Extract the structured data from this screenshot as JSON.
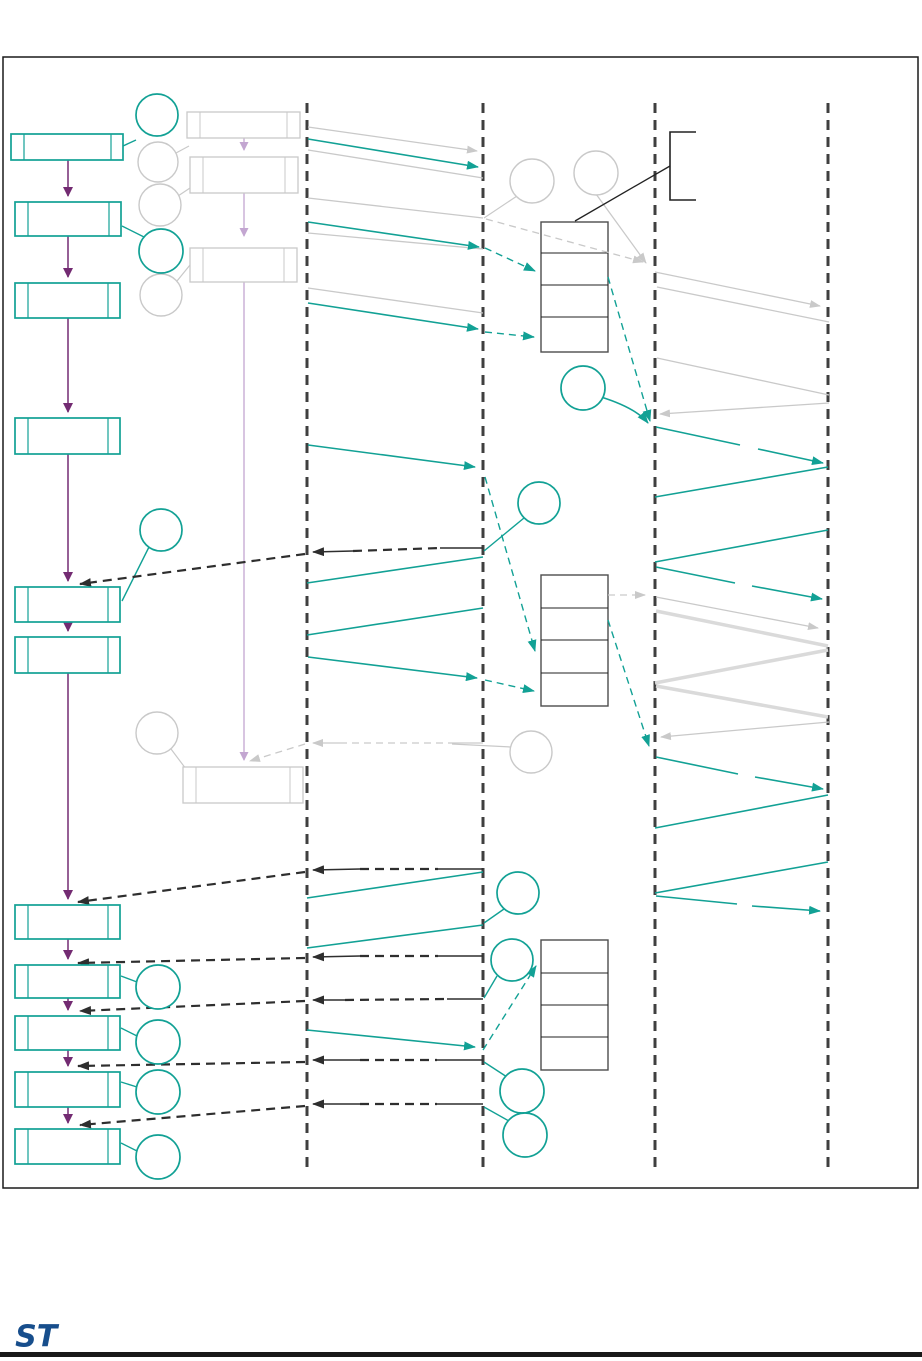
{
  "page": {
    "background": "#ffffff"
  },
  "logo": {
    "text": "ST",
    "name": "st-logo"
  },
  "colors": {
    "teal": "#12a195",
    "purple": "#732b72",
    "violet": "#c3a6d1",
    "dark": "#2e2e2e",
    "lifeline": "#3f3f3f",
    "gray_shape": "#c9c9c9",
    "gray_line": "#c9c9c9",
    "gray_thick": "#dadada",
    "table_border": "#4d4d4d",
    "table_divider": "#222222",
    "frame": "#1a1a1a",
    "bracket": "#222222",
    "logo_blue": "#174e8c",
    "footer_rule": "#191919",
    "box_fill": "#ffffff"
  },
  "diagram": {
    "frame": {
      "x": 3,
      "y": 57,
      "w": 915,
      "h": 1131
    },
    "lifelines": {
      "xs": [
        307,
        483,
        655,
        828
      ],
      "y1": 103,
      "y2": 1168
    },
    "flow_boxes": [
      [
        11,
        134,
        112,
        26
      ],
      [
        15,
        202,
        106,
        34
      ],
      [
        15,
        283,
        105,
        35
      ],
      [
        15,
        418,
        105,
        36
      ],
      [
        15,
        587,
        105,
        35
      ],
      [
        15,
        637,
        105,
        36
      ],
      [
        15,
        905,
        105,
        34
      ],
      [
        15,
        965,
        105,
        33
      ],
      [
        15,
        1016,
        105,
        34
      ],
      [
        15,
        1072,
        105,
        35
      ],
      [
        15,
        1129,
        105,
        35
      ]
    ],
    "gray_boxes": [
      [
        187,
        112,
        113,
        26
      ],
      [
        190,
        157,
        108,
        36
      ],
      [
        190,
        248,
        107,
        34
      ],
      [
        183,
        767,
        120,
        36
      ]
    ],
    "teal_circles": [
      [
        157,
        115,
        21
      ],
      [
        161,
        251,
        22
      ],
      [
        161,
        530,
        21
      ],
      [
        583,
        388,
        22
      ],
      [
        539,
        503,
        21
      ],
      [
        518,
        893,
        21
      ],
      [
        512,
        960,
        21
      ],
      [
        522,
        1091,
        22
      ],
      [
        525,
        1135,
        22
      ],
      [
        158,
        987,
        22
      ],
      [
        158,
        1042,
        22
      ],
      [
        158,
        1092,
        22
      ],
      [
        158,
        1157,
        22
      ]
    ],
    "gray_circles": [
      [
        158,
        162,
        20
      ],
      [
        160,
        205,
        21
      ],
      [
        161,
        295,
        21
      ],
      [
        532,
        181,
        22
      ],
      [
        596,
        173,
        22
      ],
      [
        157,
        733,
        21
      ],
      [
        531,
        752,
        21
      ]
    ],
    "tables": [
      {
        "x": 541,
        "y": 222,
        "w": 67,
        "h": 130,
        "rows": [
          253,
          285,
          317
        ]
      },
      {
        "x": 541,
        "y": 575,
        "w": 67,
        "h": 131,
        "rows": [
          608,
          640,
          673
        ]
      },
      {
        "x": 541,
        "y": 940,
        "w": 67,
        "h": 130,
        "rows": [
          973,
          1005,
          1037
        ]
      }
    ],
    "bracket_path": "M696,132 L670,132 L670,200 L696,200",
    "black_line": [
      575,
      221,
      670,
      166
    ],
    "teal_curve": "M601,397 Q636,408 648,423",
    "lines": {
      "teal_arrow": [
        [
          308,
          139,
          478,
          167
        ],
        [
          308,
          222,
          479,
          247
        ],
        [
          308,
          303,
          478,
          329
        ],
        [
          308,
          445,
          475,
          467
        ],
        [
          308,
          657,
          477,
          678
        ],
        [
          307,
          1030,
          475,
          1047
        ],
        [
          758,
          449,
          823,
          463
        ],
        [
          752,
          586,
          822,
          599
        ],
        [
          755,
          777,
          823,
          789
        ],
        [
          752,
          906,
          820,
          911
        ]
      ],
      "teal_line": [
        [
          656,
          427,
          740,
          445
        ],
        [
          656,
          567,
          735,
          583
        ],
        [
          656,
          757,
          738,
          774
        ],
        [
          656,
          896,
          737,
          904
        ],
        [
          483,
          557,
          307,
          583
        ],
        [
          483,
          608,
          307,
          635
        ],
        [
          483,
          872,
          307,
          898
        ],
        [
          307,
          948,
          483,
          925
        ],
        [
          828,
          467,
          655,
          497
        ],
        [
          828,
          530,
          655,
          562
        ],
        [
          828,
          795,
          655,
          828
        ],
        [
          828,
          862,
          655,
          893
        ]
      ],
      "teal_dash_arrow": [
        [
          485,
          248,
          535,
          271
        ],
        [
          485,
          332,
          534,
          337
        ],
        [
          608,
          277,
          650,
          421
        ],
        [
          485,
          477,
          535,
          651
        ],
        [
          485,
          680,
          534,
          691
        ],
        [
          608,
          620,
          649,
          746
        ],
        [
          483,
          1050,
          536,
          966
        ]
      ],
      "teal_leader": [
        [
          136,
          140,
          123,
          146
        ],
        [
          146,
          238,
          122,
          226
        ],
        [
          150,
          545,
          122,
          601
        ],
        [
          524,
          518,
          484,
          551
        ],
        [
          504,
          909,
          484,
          923
        ],
        [
          497,
          976,
          484,
          998
        ],
        [
          507,
          1077,
          484,
          1062
        ],
        [
          509,
          1121,
          484,
          1107
        ],
        [
          137,
          982,
          121,
          976
        ],
        [
          137,
          1036,
          121,
          1028
        ],
        [
          137,
          1087,
          121,
          1082
        ],
        [
          137,
          1151,
          121,
          1143
        ]
      ],
      "gray_arrow": [
        [
          308,
          127,
          477,
          151
        ],
        [
          596,
          194,
          646,
          263
        ],
        [
          655,
          272,
          820,
          306
        ],
        [
          656,
          597,
          818,
          628
        ],
        [
          829,
          403,
          660,
          414
        ],
        [
          829,
          722,
          661,
          737
        ]
      ],
      "gray_line": [
        [
          308,
          150,
          483,
          178
        ],
        [
          308,
          198,
          483,
          218
        ],
        [
          308,
          233,
          483,
          249
        ],
        [
          308,
          288,
          483,
          313
        ],
        [
          657,
          287,
          829,
          322
        ],
        [
          657,
          358,
          829,
          395
        ]
      ],
      "gray_leader": [
        [
          176,
          153,
          189,
          146
        ],
        [
          178,
          196,
          190,
          188
        ],
        [
          177,
          281,
          190,
          265
        ],
        [
          517,
          196,
          484,
          218
        ],
        [
          171,
          749,
          186,
          769
        ],
        [
          511,
          747,
          452,
          744
        ]
      ],
      "gray_dash_arrow": [
        [
          486,
          219,
          643,
          262
        ],
        [
          608,
          595,
          645,
          595
        ],
        [
          305,
          744,
          250,
          761
        ]
      ],
      "gray_stub": [
        [
          451,
          743,
          483,
          743
        ]
      ],
      "gray_arrow_stub": [
        [
          340,
          743,
          313,
          743
        ]
      ],
      "gray_dash_mid": [
        [
          340,
          743,
          451,
          743
        ]
      ],
      "thick_gray": [
        [
          656,
          611,
          828,
          646
        ],
        [
          828,
          650,
          655,
          683
        ],
        [
          656,
          686,
          828,
          717
        ]
      ],
      "dark_stub": [
        [
          440,
          548,
          483,
          548
        ],
        [
          438,
          869,
          483,
          869
        ],
        [
          438,
          956,
          483,
          956
        ],
        [
          447,
          999,
          483,
          999
        ],
        [
          437,
          1060,
          483,
          1060
        ],
        [
          437,
          1104,
          483,
          1104
        ]
      ],
      "dark_arrow_stub": [
        [
          353,
          551,
          313,
          552
        ],
        [
          360,
          869,
          313,
          870
        ],
        [
          360,
          956,
          313,
          957
        ],
        [
          345,
          1000,
          313,
          1000
        ],
        [
          360,
          1060,
          313,
          1060
        ],
        [
          360,
          1104,
          313,
          1104
        ]
      ],
      "dark_dash_mid": [
        [
          353,
          551,
          440,
          548
        ],
        [
          360,
          869,
          438,
          869
        ],
        [
          360,
          956,
          438,
          956
        ],
        [
          345,
          1000,
          447,
          999
        ],
        [
          360,
          1060,
          437,
          1060
        ],
        [
          360,
          1104,
          437,
          1104
        ]
      ],
      "dark_dash_arrow": [
        [
          305,
          554,
          80,
          584
        ],
        [
          305,
          872,
          78,
          902
        ],
        [
          305,
          958,
          78,
          963
        ],
        [
          305,
          1001,
          80,
          1011
        ],
        [
          305,
          1062,
          78,
          1066
        ],
        [
          305,
          1106,
          80,
          1125
        ]
      ],
      "purple_arrow": [
        [
          68,
          160,
          68,
          196
        ],
        [
          68,
          236,
          68,
          277
        ],
        [
          68,
          318,
          68,
          412
        ],
        [
          68,
          454,
          68,
          581
        ],
        [
          68,
          622,
          68,
          631
        ],
        [
          68,
          673,
          68,
          899
        ],
        [
          68,
          939,
          68,
          959
        ],
        [
          68,
          998,
          68,
          1010
        ],
        [
          68,
          1050,
          68,
          1066
        ],
        [
          68,
          1107,
          68,
          1123
        ]
      ],
      "violet_arrow": [
        [
          244,
          138,
          244,
          150
        ],
        [
          244,
          193,
          244,
          236
        ],
        [
          244,
          282,
          244,
          760
        ]
      ]
    }
  }
}
